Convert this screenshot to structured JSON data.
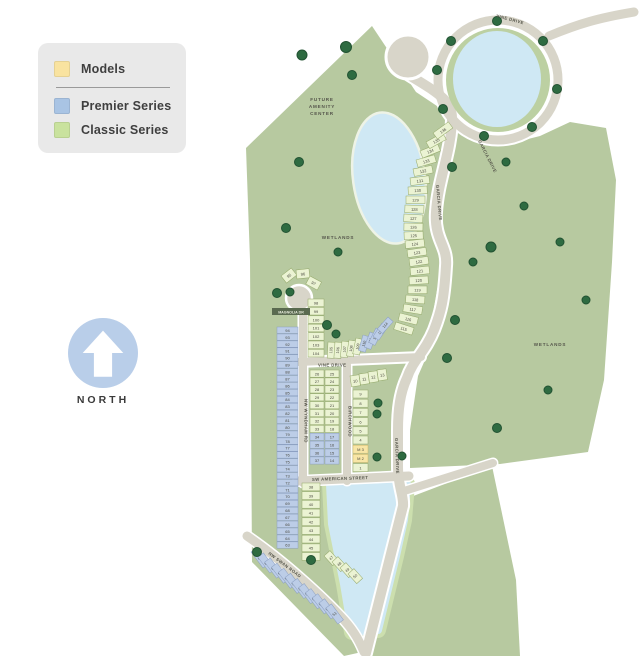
{
  "legend": {
    "items": [
      {
        "id": "models",
        "label": "Models",
        "color": "#f9e3a0"
      },
      {
        "id": "premier",
        "label": "Premier Series",
        "color": "#a9c4e4"
      },
      {
        "id": "classic",
        "label": "Classic Series",
        "color": "#c9e29e"
      }
    ]
  },
  "north_label": "NORTH",
  "map": {
    "colors": {
      "classic": {
        "fill": "#ebf3d3",
        "stroke": "#93a869"
      },
      "premier": {
        "fill": "#bccde7",
        "stroke": "#8b9fc2"
      },
      "model": {
        "fill": "#f8e6a6",
        "stroke": "#cdb464"
      }
    },
    "area_labels": {
      "future_amenity": [
        "FUTURE",
        "AMENITY",
        "CENTER"
      ],
      "wetlands_left": "WETLANDS",
      "wetlands_right": "WETLANDS"
    },
    "streets": {
      "vine_top": "VINE DRIVE",
      "garcia_upper": "GARCIA DRIVE",
      "garcia_mid": "GARCIA DRIVE",
      "magnolia": "MAGNOLIA DR",
      "wyndham": "NW WYNDHAM RD",
      "vine_mid": "VINE DRIVE",
      "birchwood": "BIRCHWOOD",
      "american": "SW AMERICAN STREET",
      "swan": "NW SWAN ROAD",
      "garcia_lower": "GARCIA DRIVE"
    },
    "lot_groups": [
      {
        "name": "premier-west-column",
        "series": "premier",
        "x": 277,
        "y": 327,
        "w": 21,
        "h": 6.4,
        "dy": 6.93,
        "fs": 4,
        "lots": [
          "94",
          "93",
          "92",
          "91",
          "90",
          "89",
          "88",
          "87",
          "86",
          "85",
          "84",
          "83",
          "82",
          "81",
          "80",
          "79",
          "78",
          "77",
          "76",
          "75",
          "74",
          "73",
          "72",
          "71",
          "70",
          "69",
          "68",
          "67",
          "66",
          "65",
          "64",
          "63"
        ]
      },
      {
        "name": "culdesac-arc",
        "series": "classic",
        "w": 13,
        "h": 9,
        "fs": 4,
        "lots": [
          "95",
          "96",
          "97"
        ],
        "positions": [
          {
            "x": 281,
            "y": 276,
            "a": -38
          },
          {
            "x": 296,
            "y": 270,
            "a": -6
          },
          {
            "x": 310,
            "y": 276,
            "a": 28
          }
        ]
      },
      {
        "name": "classic-98-column",
        "series": "classic",
        "x": 308,
        "y": 299,
        "w": 16,
        "h": 7.6,
        "dy": 8.4,
        "fs": 4,
        "lots": [
          "98",
          "99",
          "100",
          "101",
          "102",
          "103",
          "104"
        ]
      },
      {
        "name": "classic-vine-row",
        "series": "classic",
        "w": 7,
        "h": 16,
        "fs": 3.8,
        "textAngle": -90,
        "lots": [
          "105",
          "106",
          "107",
          "108",
          "109"
        ],
        "positions": [
          {
            "x": 328,
            "y": 342,
            "a": 3
          },
          {
            "x": 335,
            "y": 342,
            "a": 4
          },
          {
            "x": 342,
            "y": 341,
            "a": 6
          },
          {
            "x": 349,
            "y": 340,
            "a": 9
          },
          {
            "x": 356,
            "y": 338,
            "a": 12
          }
        ]
      },
      {
        "name": "premier-vine-row",
        "series": "premier",
        "w": 7,
        "h": 16,
        "fs": 3.8,
        "textAngle": -90,
        "lots": [
          "110",
          "111",
          "112",
          "113",
          "114"
        ],
        "positions": [
          {
            "x": 363,
            "y": 335,
            "a": 16
          },
          {
            "x": 370,
            "y": 332,
            "a": 21
          },
          {
            "x": 376,
            "y": 328,
            "a": 27
          },
          {
            "x": 382,
            "y": 323,
            "a": 34
          },
          {
            "x": 388,
            "y": 317,
            "a": 42
          }
        ]
      },
      {
        "name": "classic-garcia-column",
        "series": "classic",
        "w": 19,
        "h": 7.6,
        "fs": 4,
        "lots": [
          "115",
          "116",
          "117",
          "118",
          "119",
          "120",
          "121",
          "122",
          "123",
          "124",
          "125",
          "126",
          "127",
          "128",
          "129",
          "130",
          "131",
          "132",
          "133",
          "134",
          "135",
          "136"
        ],
        "positions": [
          {
            "x": 396,
            "y": 322,
            "a": 18
          },
          {
            "x": 400,
            "y": 313,
            "a": 14
          },
          {
            "x": 404,
            "y": 304,
            "a": 9
          },
          {
            "x": 406,
            "y": 295,
            "a": 4
          },
          {
            "x": 408,
            "y": 286,
            "a": 0
          },
          {
            "x": 409,
            "y": 277,
            "a": -3
          },
          {
            "x": 410,
            "y": 268,
            "a": -6
          },
          {
            "x": 409,
            "y": 259,
            "a": -8
          },
          {
            "x": 407,
            "y": 250,
            "a": -8
          },
          {
            "x": 405,
            "y": 241,
            "a": -6
          },
          {
            "x": 404,
            "y": 232,
            "a": -2
          },
          {
            "x": 404,
            "y": 223,
            "a": 1
          },
          {
            "x": 404,
            "y": 214,
            "a": 3
          },
          {
            "x": 405,
            "y": 205,
            "a": 2
          },
          {
            "x": 406,
            "y": 196,
            "a": 0
          },
          {
            "x": 408,
            "y": 187,
            "a": -3
          },
          {
            "x": 410,
            "y": 178,
            "a": -7
          },
          {
            "x": 413,
            "y": 169,
            "a": -11
          },
          {
            "x": 416,
            "y": 160,
            "a": -16
          },
          {
            "x": 420,
            "y": 151,
            "a": -22
          },
          {
            "x": 426,
            "y": 142,
            "a": -29
          },
          {
            "x": 433,
            "y": 133,
            "a": -36
          }
        ]
      },
      {
        "name": "classic-mid-col-a",
        "series": "classic",
        "x": 310,
        "y": 370,
        "w": 14,
        "h": 7.2,
        "dy": 7.9,
        "fs": 4,
        "lots": [
          "26",
          "27",
          "28",
          "29",
          "30",
          "31",
          "32",
          "33"
        ]
      },
      {
        "name": "premier-mid-col-a",
        "series": "premier",
        "x": 310,
        "y": 433.2,
        "w": 14,
        "h": 7.2,
        "dy": 7.9,
        "fs": 4,
        "lots": [
          "34",
          "35",
          "36",
          "37"
        ]
      },
      {
        "name": "classic-mid-col-b",
        "series": "classic",
        "x": 325,
        "y": 370,
        "w": 14,
        "h": 7.2,
        "dy": 7.9,
        "fs": 4,
        "lots": [
          "25",
          "24",
          "23",
          "22",
          "21",
          "20",
          "19",
          "18"
        ]
      },
      {
        "name": "premier-mid-col-b",
        "series": "premier",
        "x": 325,
        "y": 433.2,
        "w": 14,
        "h": 7.2,
        "dy": 7.9,
        "fs": 4,
        "lots": [
          "17",
          "16",
          "15",
          "14"
        ]
      },
      {
        "name": "classic-diag-row",
        "series": "classic",
        "w": 9,
        "h": 11,
        "fs": 4,
        "lots": [
          "10",
          "11",
          "12",
          "13"
        ],
        "positions": [
          {
            "x": 350,
            "y": 376,
            "a": -8
          },
          {
            "x": 359,
            "y": 374,
            "a": -8
          },
          {
            "x": 368,
            "y": 372,
            "a": -8
          },
          {
            "x": 377,
            "y": 370,
            "a": -8
          }
        ]
      },
      {
        "name": "classic-east-col",
        "series": "classic",
        "x": 353,
        "y": 390,
        "w": 15,
        "h": 8,
        "dy": 9.2,
        "fs": 4,
        "lots": [
          "9",
          "8",
          "7",
          "6",
          "5",
          "4"
        ]
      },
      {
        "name": "model-lots",
        "series": "model",
        "x": 353,
        "y": 445.2,
        "w": 15,
        "h": 8,
        "dy": 9.2,
        "fs": 4,
        "lots": [
          "M 3",
          "M 2"
        ]
      },
      {
        "name": "classic-lot-1",
        "series": "classic",
        "x": 353,
        "y": 463.6,
        "w": 15,
        "h": 8,
        "fs": 4,
        "lots": [
          "1"
        ]
      },
      {
        "name": "classic-38-column",
        "series": "classic",
        "x": 302,
        "y": 483,
        "w": 18,
        "h": 7.8,
        "dy": 8.7,
        "fs": 4,
        "lots": [
          "38",
          "39",
          "40",
          "41",
          "42",
          "43",
          "44",
          "45",
          "46"
        ]
      },
      {
        "name": "classic-47-group",
        "series": "classic",
        "w": 8,
        "h": 13,
        "fs": 3.8,
        "lots": [
          "47",
          "48",
          "49",
          "50"
        ],
        "positions": [
          {
            "x": 324,
            "y": 556,
            "a": -42
          },
          {
            "x": 332,
            "y": 562,
            "a": -42
          },
          {
            "x": 340,
            "y": 568,
            "a": -42
          },
          {
            "x": 348,
            "y": 574,
            "a": -42
          }
        ]
      },
      {
        "name": "premier-swan-strip",
        "series": "premier",
        "w": 7,
        "h": 20,
        "fs": 3.8,
        "lots": [
          "62",
          "61",
          "60",
          "59",
          "58",
          "57",
          "56",
          "55",
          "54",
          "53",
          "52",
          "51"
        ],
        "positions": [
          {
            "x": 251,
            "y": 552,
            "a": -37
          },
          {
            "x": 257.8,
            "y": 557.1,
            "a": -37
          },
          {
            "x": 264.6,
            "y": 562.2,
            "a": -37
          },
          {
            "x": 271.4,
            "y": 567.3,
            "a": -37
          },
          {
            "x": 278.2,
            "y": 572.4,
            "a": -37
          },
          {
            "x": 285,
            "y": 577.5,
            "a": -37
          },
          {
            "x": 291.8,
            "y": 582.6,
            "a": -37
          },
          {
            "x": 298.6,
            "y": 587.7,
            "a": -37
          },
          {
            "x": 305.4,
            "y": 592.8,
            "a": -37
          },
          {
            "x": 312.2,
            "y": 597.9,
            "a": -37
          },
          {
            "x": 319,
            "y": 603,
            "a": -37
          },
          {
            "x": 325.8,
            "y": 608.1,
            "a": -37
          }
        ]
      }
    ]
  }
}
